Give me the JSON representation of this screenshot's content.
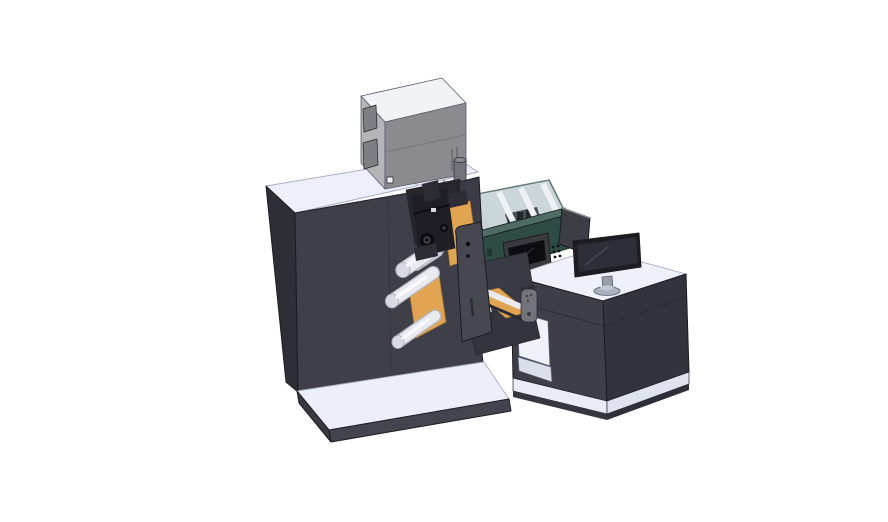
{
  "scene": {
    "description": "3D CAD render of a narrow-web label printing press with roller unwind section, electrical enclosure on top, print unit with HMI screen under a transparent safety cover, and an operator desk with a monitor and hand pendant",
    "background": "#ffffff"
  },
  "components": {
    "press_cabinet": "Main press cabinet",
    "base_plate": "Machine base plate",
    "enclosure_box": "Electrical enclosure",
    "vent": "Vent cylinder",
    "unwind_unit": "Unwind roller section",
    "rollers": "Web guide rollers",
    "print_unit": "Print unit with HMI screen",
    "safety_cover": "Transparent safety cover",
    "rear_panel": "Rear display panel",
    "desk": "Operator desk",
    "monitor": "Desktop monitor",
    "pendant": "Hand-held control pendant"
  },
  "colors": {
    "background": "#ffffff",
    "machine_top": "#edf0fa",
    "machine_top_seam": "#c7cbd9",
    "machine_front": "#3f3f4a",
    "machine_side": "#2e2e37",
    "machine_seam": "#35353f",
    "recess": "#26262c",
    "hole_rim": "#50505c",
    "base_top": "#eceffa",
    "base_front": "#44444f",
    "base_side": "#383842",
    "box_top": "#f2f3f6",
    "box_left": "#b4b4b9",
    "box_front": "#8a8a8f",
    "box_seam": "#77777c",
    "box_window": "#7e7e85",
    "box_slot": "#6a6a70",
    "box_tag": "#f0f0f2",
    "vent": "#73737a",
    "vent_top": "#8d8d94",
    "vent_base": "#5a5a60",
    "glass": "#c7d2d7",
    "slat": "#eff2f4",
    "inner_parts": "#31373d",
    "head": "#22272c",
    "magenta": "#c457ce",
    "teal_rim": "#516c66",
    "teal_front": "#2e4b45",
    "teal_dark": "#1e3530",
    "hmi_bezel": "#393940",
    "hmi_screen": "#0d0d11",
    "hmi_shine": "#2e3138",
    "button": "#0f1114",
    "rear_panel": "#3d3d46",
    "rear_panel_edge": "#83838c",
    "end_plate": "#3c3c46",
    "bridge": "#3a3a44",
    "housing": "#34343e",
    "orange": "#e0a453",
    "roller_edge": "#b4b8c3",
    "roller": "#e8eaf0",
    "roller_highlight": "#f8f9fc",
    "roller_cap": "#d7dae2",
    "swing_plate": "#474751",
    "mech": "#1e1e24",
    "mech_light": "#2c2c34",
    "mech_detail": "#0c0c10",
    "mech_ring": "#3c3c44",
    "speck": "#d9dadf",
    "desk_top": "#eef1fa",
    "desk_front": "#3e3e49",
    "desk_side": "#33333d",
    "desk_seam": "#2c2c36",
    "kneehole": "#f0f2f9",
    "kneehole_shade": "#dbdfec",
    "desk_plinth": "#e9ecf6",
    "desk_plinth_side": "#dfe3ef",
    "desk_plinth_dark": "#363640",
    "desk_plinth_dark2": "#2f2f39",
    "monitor_bezel": "#1c1c22",
    "monitor_screen": "#2e2e38",
    "monitor_reflection": "#4a4a56",
    "stand": "#979dab",
    "stand_base": "#a9afbc",
    "stand_top": "#c2c7d1",
    "pendant": "#73737b",
    "pendant_dark": "#3a3a43",
    "pendant_bracket": "#2f2f37",
    "guide_bar": "#2a2a31",
    "screw": "#9aa0b0"
  }
}
